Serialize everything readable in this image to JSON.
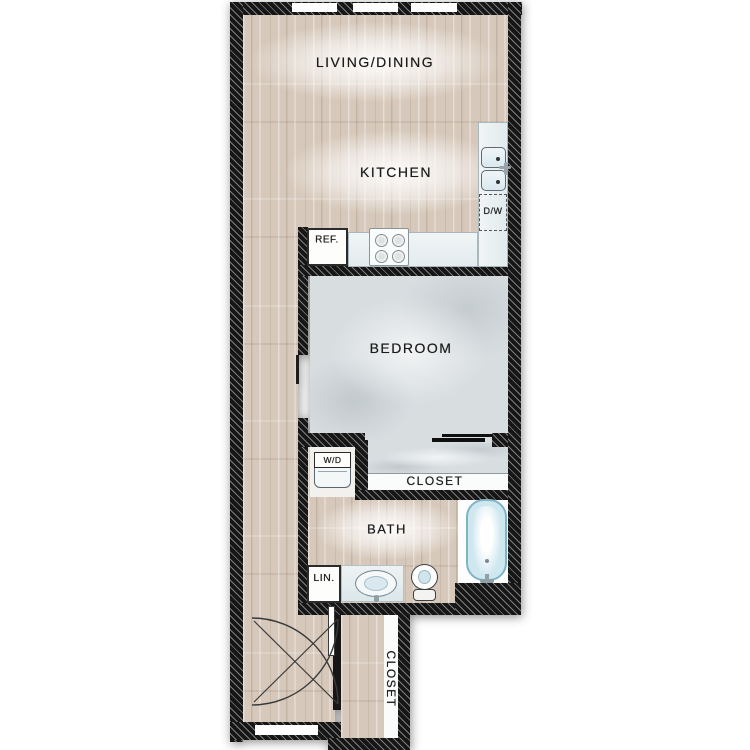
{
  "labels": {
    "living_dining": "LIVING/DINING",
    "kitchen": "KITCHEN",
    "dishwasher": "D/W",
    "refrigerator": "REF.",
    "bedroom": "BEDROOM",
    "washer_dryer": "W/D",
    "bedroom_closet": "CLOSET",
    "bath": "BATH",
    "linen": "LIN.",
    "entry_closet": "CLOSET"
  },
  "fixture_names": [
    "refrigerator",
    "stove-4-burner",
    "kitchen-double-sink",
    "dishwasher",
    "washer-dryer-unit",
    "bathtub",
    "toilet",
    "vanity-sink",
    "linen-closet",
    "entry-double-doors",
    "bedroom-closet-sliding-doors"
  ],
  "windows": {
    "top_wall_count": 3,
    "entry_wall_count": 1
  },
  "colors": {
    "wood": "#d6c8ba",
    "carpet": "#d8dde0",
    "wall": "#161616",
    "counter-border": "#aab8bd",
    "basin": "#d9e9ef",
    "tub-fill": "#cfe7ef",
    "tub-border": "#7fb4c6",
    "ink": "#1c1c1c"
  }
}
